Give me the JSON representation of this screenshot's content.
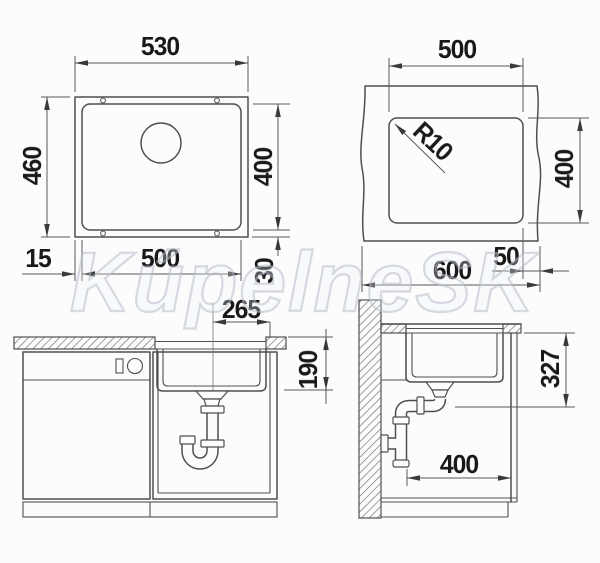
{
  "watermark": "KúpelneSK",
  "top_view": {
    "outer_width": "530",
    "outer_depth": "460",
    "bowl_width": "500",
    "bowl_depth": "400",
    "rim_side": "15",
    "rim_bottom": "30"
  },
  "cutout_view": {
    "cutout_width": "500",
    "cutout_height": "400",
    "corner_radius": "R10",
    "edge_offset": "50",
    "panel_width": "600"
  },
  "front_view": {
    "drain_offset": "265",
    "bowl_inner_depth": "190"
  },
  "side_view": {
    "install_depth": "327",
    "cabinet_clearance": "400"
  }
}
